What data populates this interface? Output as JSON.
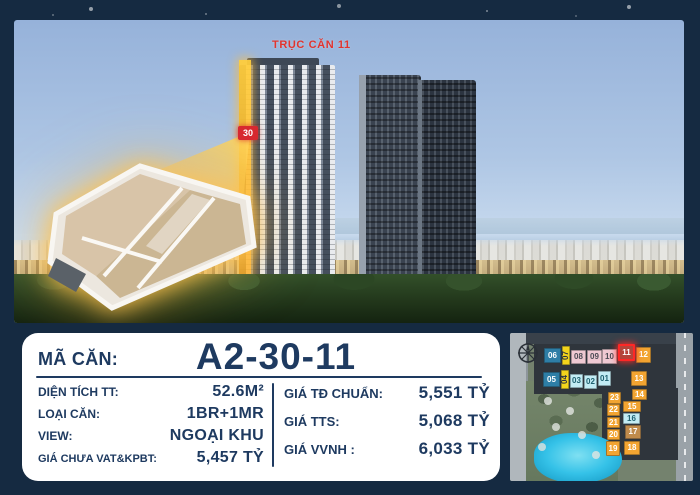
{
  "page": {
    "background": "#152a41"
  },
  "photo": {
    "axis_label": "TRỤC CĂN 11",
    "floor_badge": "30",
    "accent_red": "#d7282f",
    "highlight_yellow": "#ffc832"
  },
  "card": {
    "ma_can_label": "MÃ CĂN:",
    "ma_can_value": "A2-30-11",
    "text_color": "#1e3a60",
    "left_rows": [
      {
        "label": "DIỆN TÍCH TT:",
        "value": "52.6M²"
      },
      {
        "label": "LOẠI CĂN:",
        "value": "1BR+1MR"
      },
      {
        "label": "VIEW:",
        "value": "NGOẠI KHU"
      },
      {
        "label": "GIÁ CHƯA VAT&KPBT:",
        "value": "5,457 TỶ"
      }
    ],
    "right_rows": [
      {
        "label": "GIÁ TĐ CHUẨN:",
        "value": "5,551 TỶ"
      },
      {
        "label": "GIÁ TTS:",
        "value": "5,068 TỶ"
      },
      {
        "label": "GIÁ VVNH :",
        "value": "6,033 TỶ"
      }
    ]
  },
  "map": {
    "highlighted_unit": "11",
    "units": [
      {
        "label": "06",
        "x": 34,
        "y": 15,
        "w": 17,
        "h": 15,
        "bg": "#2e7ea6",
        "fg": "#ffffff"
      },
      {
        "label": "07",
        "x": 52,
        "y": 13,
        "w": 8,
        "h": 19,
        "bg": "#f2d41c",
        "fg": "#2a3342",
        "vertical": true
      },
      {
        "label": "08",
        "x": 61,
        "y": 17,
        "w": 15,
        "h": 14,
        "bg": "#efc9d2",
        "fg": "#4c4c55"
      },
      {
        "label": "09",
        "x": 77,
        "y": 17,
        "w": 15,
        "h": 14,
        "bg": "#efc9d2",
        "fg": "#4c4c55"
      },
      {
        "label": "10",
        "x": 92,
        "y": 16,
        "w": 15,
        "h": 15,
        "bg": "#efc9d2",
        "fg": "#4c4c55"
      },
      {
        "label": "11",
        "x": 108,
        "y": 11,
        "w": 17,
        "h": 17,
        "bg": "#b5443a",
        "fg": "#ffffff",
        "highlight": true
      },
      {
        "label": "12",
        "x": 126,
        "y": 14,
        "w": 15,
        "h": 16,
        "bg": "#f2a431",
        "fg": "#ffffff"
      },
      {
        "label": "05",
        "x": 33,
        "y": 39,
        "w": 17,
        "h": 15,
        "bg": "#2e7ea6",
        "fg": "#ffffff"
      },
      {
        "label": "04",
        "x": 51,
        "y": 37,
        "w": 8,
        "h": 19,
        "bg": "#f2d41c",
        "fg": "#2a3342",
        "vertical": true
      },
      {
        "label": "03",
        "x": 60,
        "y": 41,
        "w": 13,
        "h": 14,
        "bg": "#c3ecf4",
        "fg": "#1f6170"
      },
      {
        "label": "02",
        "x": 74,
        "y": 42,
        "w": 13,
        "h": 14,
        "bg": "#c3ecf4",
        "fg": "#1f6170"
      },
      {
        "label": "01",
        "x": 88,
        "y": 38,
        "w": 13,
        "h": 15,
        "bg": "#c3ecf4",
        "fg": "#1f6170"
      },
      {
        "label": "13",
        "x": 121,
        "y": 38,
        "w": 16,
        "h": 15,
        "bg": "#f2a431",
        "fg": "#ffffff"
      },
      {
        "label": "14",
        "x": 122,
        "y": 56,
        "w": 15,
        "h": 11,
        "bg": "#f2a431",
        "fg": "#ffffff"
      },
      {
        "label": "23",
        "x": 98,
        "y": 59,
        "w": 13,
        "h": 12,
        "bg": "#f2a431",
        "fg": "#ffffff"
      },
      {
        "label": "22",
        "x": 97,
        "y": 71,
        "w": 13,
        "h": 12,
        "bg": "#f2a431",
        "fg": "#ffffff"
      },
      {
        "label": "15",
        "x": 113,
        "y": 68,
        "w": 18,
        "h": 11,
        "bg": "#f2a431",
        "fg": "#ffffff"
      },
      {
        "label": "16",
        "x": 113,
        "y": 80,
        "w": 17,
        "h": 11,
        "bg": "#c3ecf4",
        "fg": "#1f6170"
      },
      {
        "label": "21",
        "x": 97,
        "y": 84,
        "w": 13,
        "h": 11,
        "bg": "#f2a431",
        "fg": "#ffffff"
      },
      {
        "label": "17",
        "x": 115,
        "y": 92,
        "w": 16,
        "h": 14,
        "bg": "#c08b4c",
        "fg": "#ffffff"
      },
      {
        "label": "20",
        "x": 97,
        "y": 96,
        "w": 13,
        "h": 11,
        "bg": "#f2a431",
        "fg": "#ffffff"
      },
      {
        "label": "19",
        "x": 96,
        "y": 108,
        "w": 14,
        "h": 15,
        "bg": "#f2a431",
        "fg": "#ffffff"
      },
      {
        "label": "18",
        "x": 114,
        "y": 108,
        "w": 16,
        "h": 14,
        "bg": "#f2a431",
        "fg": "#ffffff"
      }
    ]
  }
}
